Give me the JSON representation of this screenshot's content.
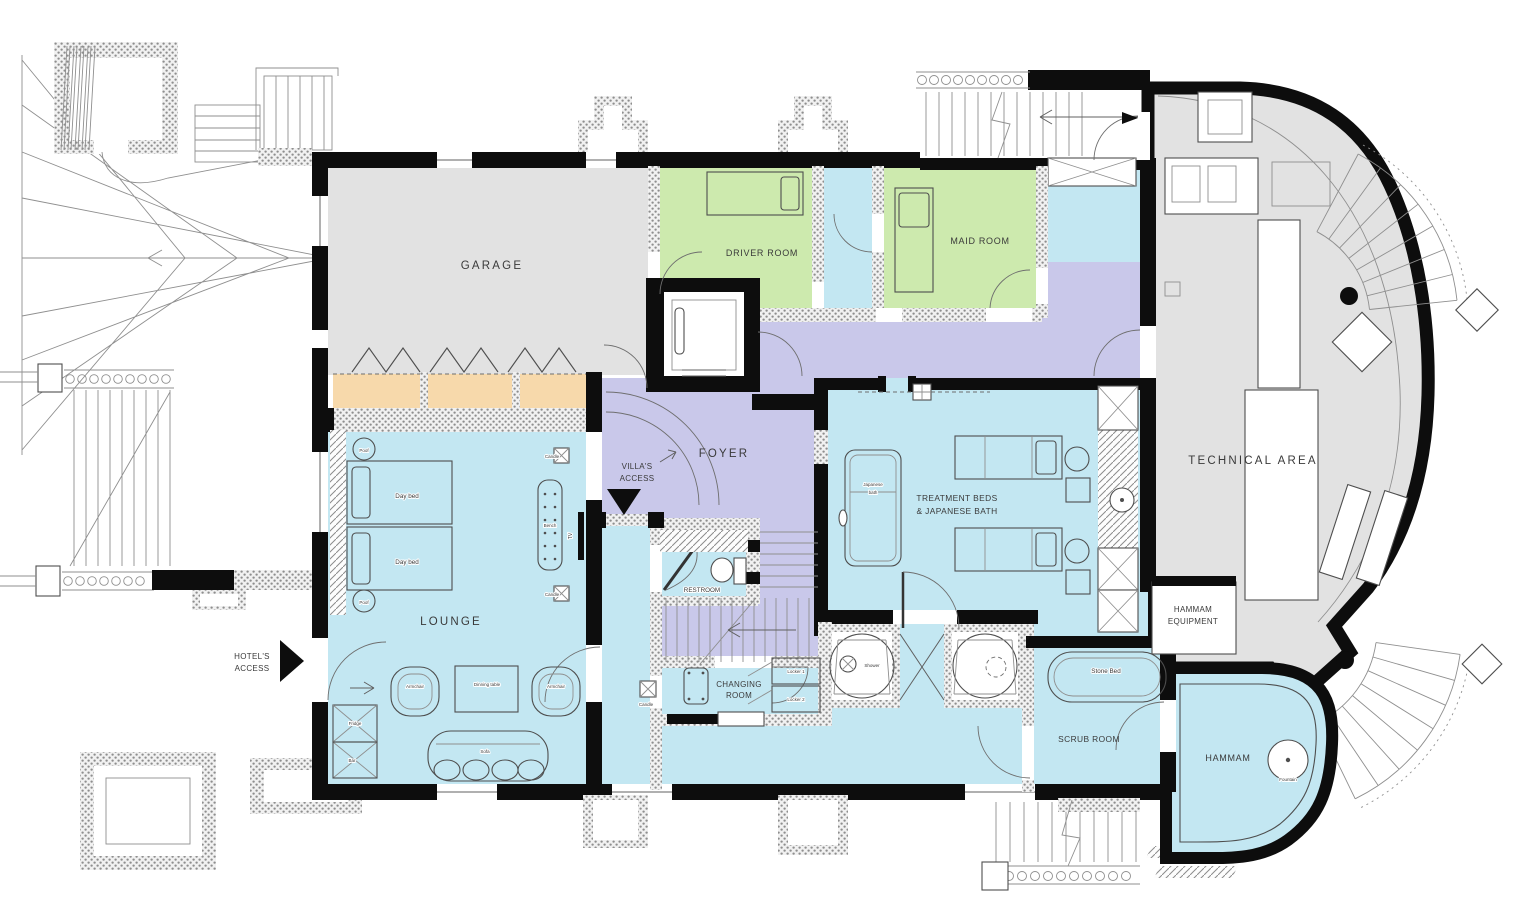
{
  "title": "Villa lower floor plan",
  "colors": {
    "cyan": "#c3e7f2",
    "green": "#cdeaae",
    "lavender": "#c9c8ea",
    "gray": "#e2e2e2",
    "tan": "#f7d9ab",
    "wall": "#0d0d0d"
  },
  "rooms": {
    "garage": "GARAGE",
    "driver_room": "DRIVER ROOM",
    "maid_room": "MAID ROOM",
    "technical_area": "TECHNICAL AREA",
    "foyer": "FOYER",
    "lounge": "LOUNGE",
    "restroom": "RESTROOM",
    "changing_room": {
      "line1": "CHANGING",
      "line2": "ROOM"
    },
    "treatment": {
      "line1": "TREATMENT BEDS",
      "line2": "& JAPANESE BATH"
    },
    "hammam_equipment": {
      "line1": "HAMMAM",
      "line2": "EQUIPMENT"
    },
    "scrub_room": "SCRUB ROOM",
    "hammam": "HAMMAM"
  },
  "access": {
    "villa": {
      "line1": "VILLA'S",
      "line2": "ACCESS"
    },
    "hotel": {
      "line1": "HOTEL'S",
      "line2": "ACCESS"
    }
  },
  "furniture": {
    "day_bed": "Day bed",
    "poof": "Poof",
    "candle": "Candle",
    "bench": "Bench",
    "tv": "TV",
    "armchair": "Armchair",
    "dinning_table": "Dinning table",
    "sofa": "Sofa",
    "fridge": "Fridge",
    "bar": "Bar",
    "japanese_bath": {
      "line1": "Japanese",
      "line2": "bath"
    },
    "locker_1": "Locker 1",
    "locker_2": "Locker 2",
    "shower": "Shower",
    "stone_bed": "Stone Bed",
    "fountain": "Fountain"
  }
}
